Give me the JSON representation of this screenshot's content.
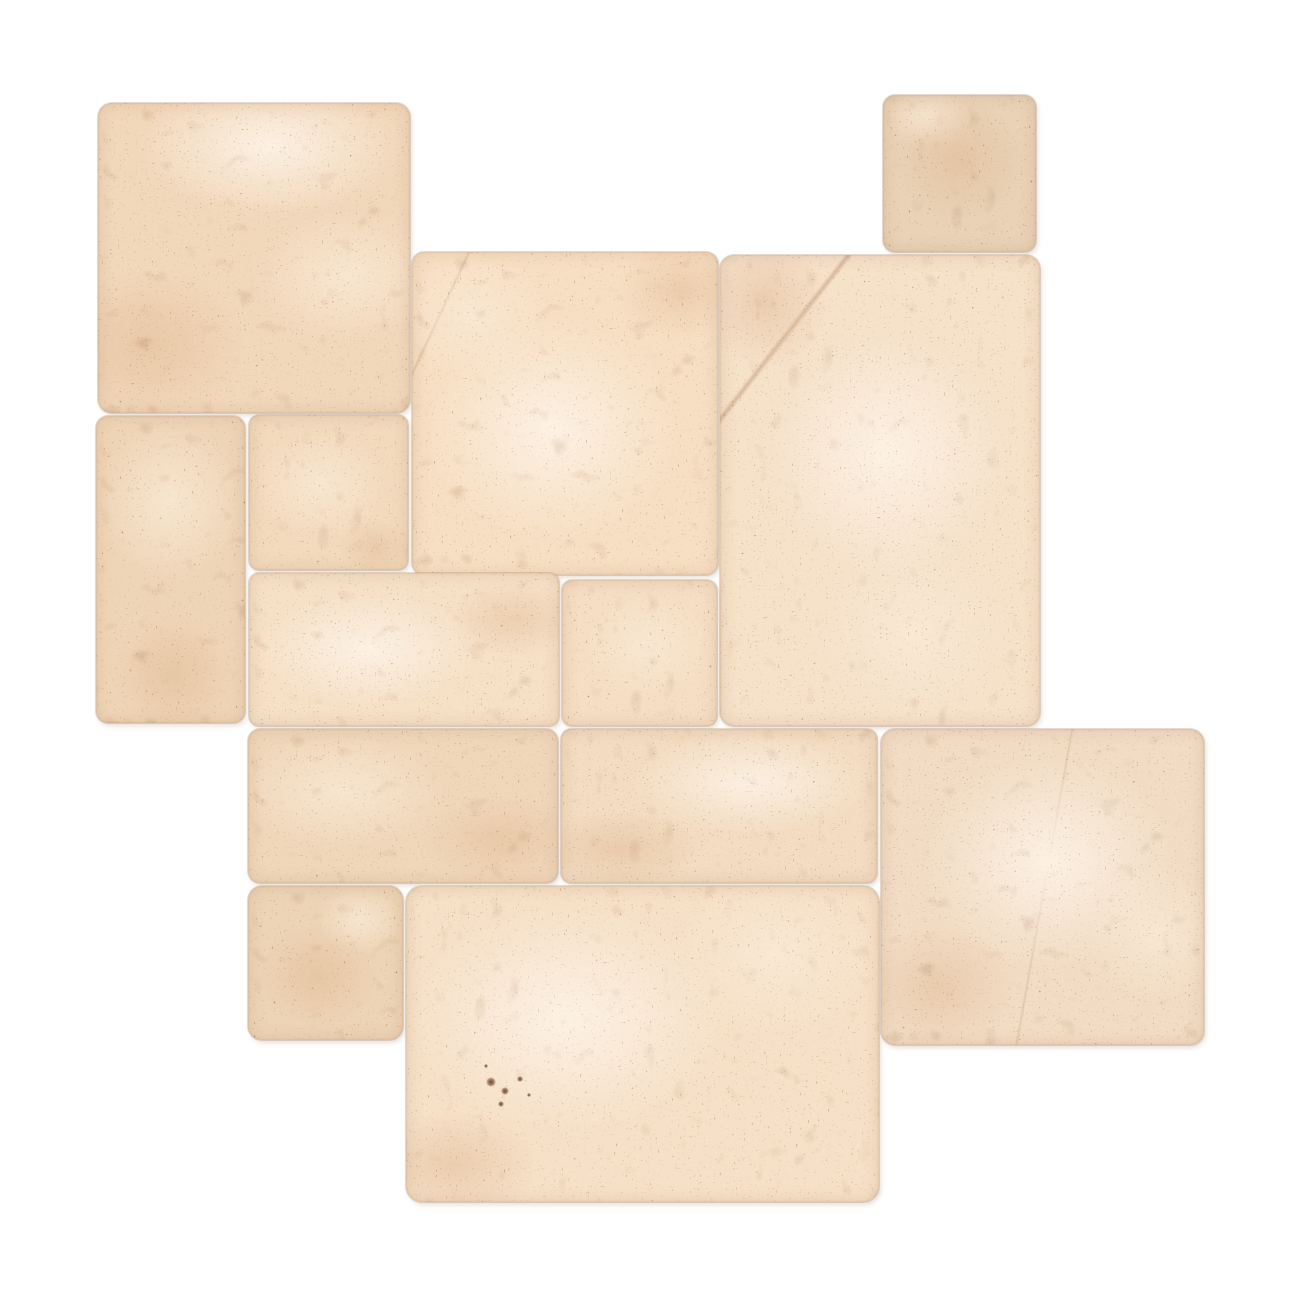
{
  "image": {
    "alt": "Ivory beige tumbled travertine stone tiles arranged in a French Versailles pattern, top view, on a plain white background",
    "background": "#ffffff",
    "width": 1300,
    "height": 1300
  },
  "palette": {
    "speckle": "#6f4526",
    "blotch": "#8a5c36",
    "seam": "rgba(168,128,94,0.28)",
    "light_wash": "rgba(253,242,229,0.95)",
    "soft_wash": "rgba(250,234,214,0.8)",
    "shade_wash": "rgba(225,187,150,0.55)"
  },
  "texture": {
    "speckle_opacity": 0.55,
    "blotch_opacity": 0.2,
    "speckle_seeds": [
      11,
      29,
      47
    ],
    "blotch_seeds": [
      5,
      17
    ]
  },
  "tiles": [
    {
      "name": "travertine-tile-16x16-top-left",
      "size_label": "16x16",
      "x": 98,
      "y": 103,
      "w": 312,
      "h": 310,
      "radius": 14,
      "seed": 1,
      "base": "#f2d8bb",
      "spots": [
        {
          "cx": 55,
          "cy": 14,
          "rx": 60,
          "ry": 32,
          "c": "rgba(253,242,229,0.95)"
        },
        {
          "cx": 16,
          "cy": 78,
          "rx": 46,
          "ry": 36,
          "c": "rgba(225,187,150,0.55)"
        },
        {
          "cx": 80,
          "cy": 56,
          "rx": 42,
          "ry": 30,
          "c": "rgba(250,234,214,0.8)"
        }
      ]
    },
    {
      "name": "travertine-tile-8x8-top-right",
      "size_label": "8x8",
      "x": 883,
      "y": 95,
      "w": 153,
      "h": 157,
      "radius": 12,
      "seed": 2,
      "base": "#e9d2b6",
      "spots": [
        {
          "cx": 50,
          "cy": 42,
          "rx": 62,
          "ry": 55,
          "c": "rgba(225,187,150,0.55)"
        },
        {
          "cx": 30,
          "cy": 15,
          "rx": 40,
          "ry": 28,
          "c": "rgba(250,234,214,0.8)"
        }
      ]
    },
    {
      "name": "travertine-tile-16x16-center",
      "size_label": "16x16",
      "x": 412,
      "y": 252,
      "w": 306,
      "h": 323,
      "radius": 12,
      "seed": 3,
      "base": "#f7dfc3",
      "vein": {
        "angle": 115,
        "at": 12,
        "w": 0.5,
        "c": "rgba(146,98,60,0.2)"
      },
      "spots": [
        {
          "cx": 46,
          "cy": 55,
          "rx": 58,
          "ry": 48,
          "c": "rgba(253,242,229,0.95)"
        },
        {
          "cx": 88,
          "cy": 12,
          "rx": 30,
          "ry": 22,
          "c": "rgba(225,187,150,0.5)"
        },
        {
          "cx": 20,
          "cy": 20,
          "rx": 35,
          "ry": 28,
          "c": "rgba(250,234,214,0.8)"
        }
      ]
    },
    {
      "name": "travertine-tile-16x24-right",
      "size_label": "16x24",
      "x": 720,
      "y": 255,
      "w": 320,
      "h": 471,
      "radius": 14,
      "seed": 4,
      "base": "#f6e1c9",
      "vein": {
        "angle": 128,
        "at": 18,
        "w": 0.7,
        "c": "rgba(146,98,60,0.3)"
      },
      "spots": [
        {
          "cx": 52,
          "cy": 42,
          "rx": 55,
          "ry": 38,
          "c": "rgba(253,242,229,0.95)"
        },
        {
          "cx": 14,
          "cy": 10,
          "rx": 28,
          "ry": 20,
          "c": "rgba(225,187,150,0.5)"
        },
        {
          "cx": 60,
          "cy": 80,
          "rx": 45,
          "ry": 30,
          "c": "rgba(250,234,214,0.8)"
        }
      ]
    },
    {
      "name": "travertine-tile-8x16-left",
      "size_label": "8x16",
      "x": 96,
      "y": 416,
      "w": 149,
      "h": 307,
      "radius": 12,
      "seed": 5,
      "base": "#efd5b7",
      "spots": [
        {
          "cx": 50,
          "cy": 28,
          "rx": 68,
          "ry": 38,
          "c": "rgba(250,234,214,0.8)"
        },
        {
          "cx": 52,
          "cy": 84,
          "rx": 60,
          "ry": 28,
          "c": "rgba(225,187,150,0.55)"
        }
      ]
    },
    {
      "name": "travertine-tile-8x8-mid-left",
      "size_label": "8x8",
      "x": 249,
      "y": 415,
      "w": 159,
      "h": 155,
      "radius": 10,
      "seed": 6,
      "base": "#f3dabd",
      "spots": [
        {
          "cx": 45,
          "cy": 45,
          "rx": 60,
          "ry": 50,
          "c": "rgba(250,234,214,0.8)"
        },
        {
          "cx": 80,
          "cy": 85,
          "rx": 35,
          "ry": 25,
          "c": "rgba(225,187,150,0.5)"
        }
      ]
    },
    {
      "name": "travertine-tile-16x8-middle",
      "size_label": "16x8",
      "x": 249,
      "y": 573,
      "w": 310,
      "h": 153,
      "radius": 10,
      "seed": 7,
      "base": "#f6e0c6",
      "spots": [
        {
          "cx": 38,
          "cy": 50,
          "rx": 52,
          "ry": 55,
          "c": "rgba(253,242,229,0.95)"
        },
        {
          "cx": 85,
          "cy": 30,
          "rx": 30,
          "ry": 35,
          "c": "rgba(225,187,150,0.45)"
        }
      ]
    },
    {
      "name": "travertine-tile-8x8-center",
      "size_label": "8x8",
      "x": 562,
      "y": 580,
      "w": 155,
      "h": 146,
      "radius": 10,
      "seed": 8,
      "base": "#f5dec3",
      "spots": [
        {
          "cx": 55,
          "cy": 45,
          "rx": 60,
          "ry": 52,
          "c": "rgba(250,234,214,0.8)"
        }
      ]
    },
    {
      "name": "travertine-tile-16x8-lower-left",
      "size_label": "16x8",
      "x": 248,
      "y": 729,
      "w": 310,
      "h": 154,
      "radius": 12,
      "seed": 9,
      "base": "#f0d7ba",
      "spots": [
        {
          "cx": 30,
          "cy": 40,
          "rx": 48,
          "ry": 52,
          "c": "rgba(250,234,214,0.8)"
        },
        {
          "cx": 82,
          "cy": 72,
          "rx": 38,
          "ry": 40,
          "c": "rgba(225,187,150,0.5)"
        }
      ]
    },
    {
      "name": "travertine-tile-16x8-lower-middle",
      "size_label": "16x8",
      "x": 561,
      "y": 729,
      "w": 316,
      "h": 154,
      "radius": 10,
      "seed": 10,
      "base": "#f3dcc1",
      "spots": [
        {
          "cx": 60,
          "cy": 35,
          "rx": 55,
          "ry": 48,
          "c": "rgba(253,242,229,0.9)"
        },
        {
          "cx": 18,
          "cy": 78,
          "rx": 38,
          "ry": 35,
          "c": "rgba(225,187,150,0.5)"
        }
      ]
    },
    {
      "name": "travertine-tile-8x8-bottom-left",
      "size_label": "8x8",
      "x": 248,
      "y": 886,
      "w": 155,
      "h": 154,
      "radius": 14,
      "seed": 11,
      "base": "#edd4b6",
      "spots": [
        {
          "cx": 45,
          "cy": 58,
          "rx": 55,
          "ry": 48,
          "c": "rgba(225,187,150,0.55)"
        },
        {
          "cx": 72,
          "cy": 22,
          "rx": 40,
          "ry": 32,
          "c": "rgba(250,234,214,0.8)"
        }
      ]
    },
    {
      "name": "travertine-tile-24x16-bottom",
      "size_label": "24x16",
      "x": 406,
      "y": 886,
      "w": 473,
      "h": 316,
      "radius": 16,
      "seed": 12,
      "base": "#f6e0c7",
      "spots": [
        {
          "cx": 34,
          "cy": 42,
          "rx": 48,
          "ry": 52,
          "c": "rgba(253,242,229,0.95)"
        },
        {
          "cx": 78,
          "cy": 22,
          "rx": 32,
          "ry": 38,
          "c": "rgba(250,234,214,0.8)"
        },
        {
          "cx": 10,
          "cy": 88,
          "rx": 26,
          "ry": 24,
          "c": "rgba(225,187,150,0.5)"
        }
      ],
      "pits": [
        {
          "x": 18,
          "y": 62,
          "r": 5
        },
        {
          "x": 21,
          "y": 65,
          "r": 4
        },
        {
          "x": 24,
          "y": 61,
          "r": 3
        },
        {
          "x": 20,
          "y": 69,
          "r": 3
        },
        {
          "x": 26,
          "y": 66,
          "r": 2
        },
        {
          "x": 17,
          "y": 57,
          "r": 2
        }
      ]
    },
    {
      "name": "travertine-tile-16x16-bottom-right",
      "size_label": "16x16",
      "x": 881,
      "y": 729,
      "w": 323,
      "h": 316,
      "radius": 14,
      "seed": 13,
      "base": "#f2dcc4",
      "vein": {
        "angle": 100,
        "at": 50,
        "w": 0.5,
        "c": "rgba(146,98,60,0.16)"
      },
      "spots": [
        {
          "cx": 52,
          "cy": 42,
          "rx": 55,
          "ry": 48,
          "c": "rgba(253,242,229,0.95)"
        },
        {
          "cx": 18,
          "cy": 82,
          "rx": 34,
          "ry": 28,
          "c": "rgba(225,187,150,0.5)"
        },
        {
          "cx": 85,
          "cy": 65,
          "rx": 30,
          "ry": 30,
          "c": "rgba(250,234,214,0.8)"
        }
      ]
    }
  ]
}
